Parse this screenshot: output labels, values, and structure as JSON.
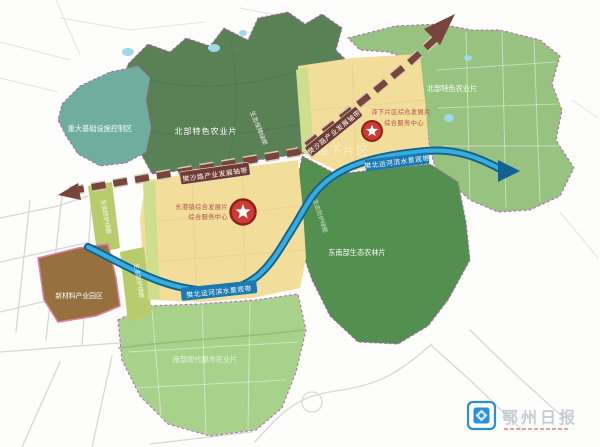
{
  "map": {
    "labels": {
      "infra_control": "重大基础设施控制区",
      "north_agri": "北部特色农业片",
      "eco_wedge": "生态保障绿楔",
      "eco_corridor": "生态防护绿廊",
      "southeast_agri": "东南部生态农林片",
      "new_material_park": "新材料产业园区",
      "south_agri": "南部现代都市农业片",
      "central_dev_line1": "长港镇综合发展片",
      "central_dev_line2": "综合服务中心",
      "east_dev_line1": "泽下片区综合发展片",
      "east_dev_line2": "综合服务中心",
      "industry_axis": "樊沙路产业发展轴带",
      "river_belt": "樊北运河滨水景观带",
      "district_faint": "泽下片区"
    },
    "colors": {
      "dark_green": "#5a8156",
      "teal": "#6fae9f",
      "light_green": "#97c27f",
      "mid_green": "#53904f",
      "south_green": "#a8d18c",
      "yellow": "#f3dd9b",
      "pale_strip": "#cede8e",
      "olive_strip": "#b9cc6d",
      "brown": "#96713f",
      "pond": "#9fd8e8",
      "river_outer": "#13618f",
      "river_inner": "#35aede",
      "axis": "#77453c",
      "axis_casing": "#d9c9b9",
      "axis_label_bg": "#6e3c32",
      "river_label_bg": "#1b7ab2",
      "star_red": "#cf3a33",
      "star_ring": "#8e1f1c",
      "red_label": "#b5524e",
      "boundary": "#bd62bd",
      "watermark_text": "#b9c0c7",
      "watermark_blue": "#2e8fd5"
    }
  },
  "watermark": {
    "name": "鄂州日报"
  }
}
